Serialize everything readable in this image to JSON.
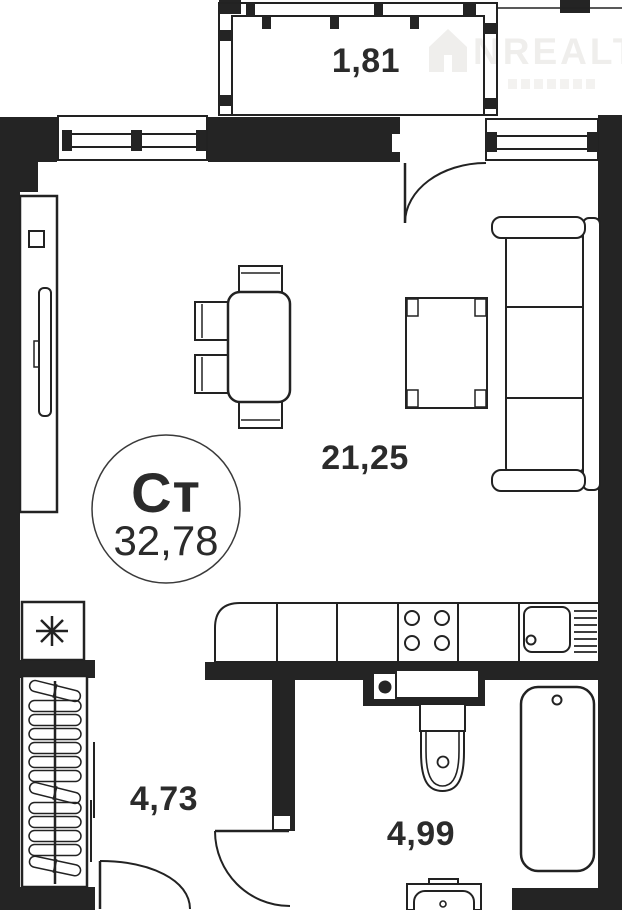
{
  "watermark": {
    "brand": "NREALT"
  },
  "unit_badge": {
    "type_code": "Ст",
    "total_area": "32,78"
  },
  "room_areas": {
    "balcony": "1,81",
    "living_room": "21,25",
    "hallway": "4,73",
    "bathroom": "4,99"
  },
  "colors": {
    "wall": "#242424",
    "line": "#222222",
    "label": "#2b2b2b",
    "watermark": "#efeeec"
  }
}
